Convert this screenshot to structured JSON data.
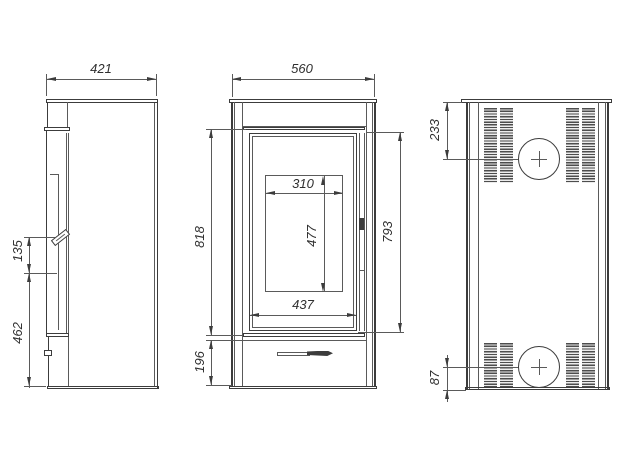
{
  "drawing": {
    "type": "technical-three-view-stove-drawing",
    "line_color": "#3c3c3c",
    "dimensions": {
      "side_width": "421",
      "side_handle": "135",
      "side_lower": "462",
      "front_width": "560",
      "front_height": "818",
      "front_base": "196",
      "door_height": "793",
      "opening_width": "310",
      "opening_height": "477",
      "glass_width": "437",
      "flue_top": "233",
      "flue_bottom": "87"
    }
  }
}
